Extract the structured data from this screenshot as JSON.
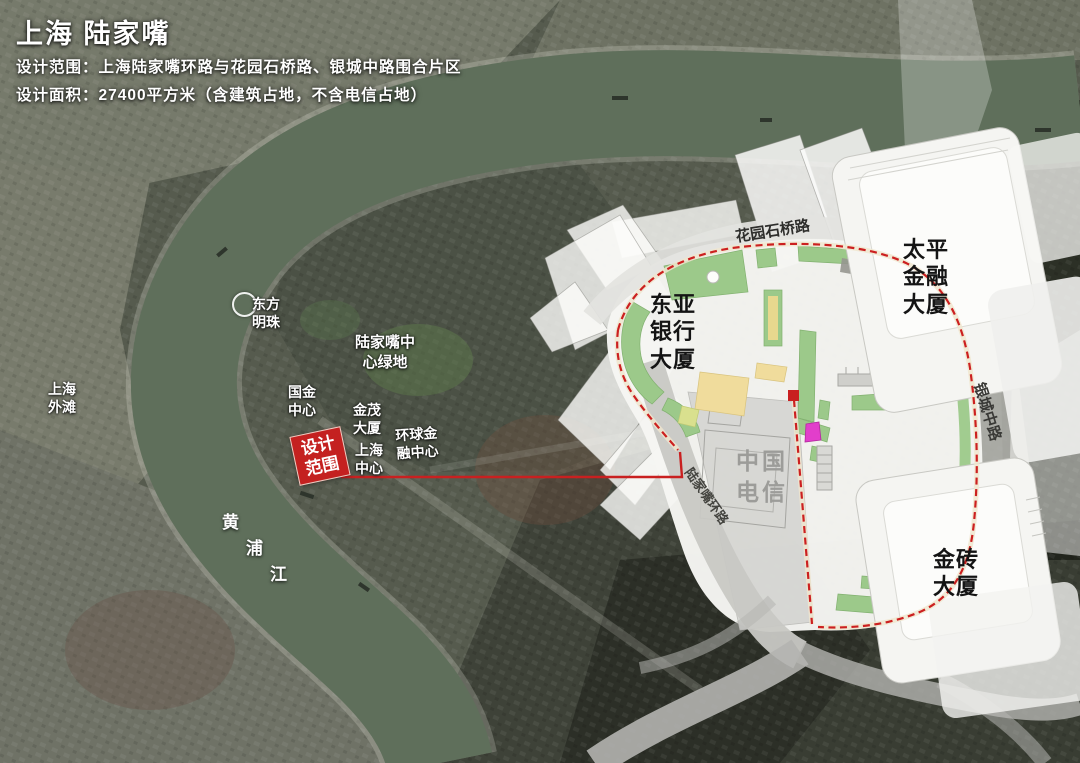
{
  "title": {
    "heading": "上海 陆家嘴",
    "scope_line": "设计范围：上海陆家嘴环路与花园石桥路、银城中路围合片区",
    "area_line": "设计面积：27400平方米（含建筑占地，不含电信占地）"
  },
  "satellite_labels": {
    "oriental_pearl": {
      "line1": "东方",
      "line2": "明珠"
    },
    "bund": {
      "line1": "上海",
      "line2": "外滩"
    },
    "ifc": {
      "line1": "国金",
      "line2": "中心"
    },
    "central_green": {
      "line1": "陆家嘴中",
      "line2": "心绿地"
    },
    "jinmao": {
      "line1": "金茂",
      "line2": "大厦"
    },
    "swfc": {
      "line1": "环球金",
      "line2": "融中心"
    },
    "shanghai_tower": {
      "line1": "上海",
      "line2": "中心"
    },
    "huangpu_river": {
      "char1": "黄",
      "char2": "浦",
      "char3": "江"
    }
  },
  "scope_tag": {
    "line1": "设计",
    "line2": "范围"
  },
  "plan_labels": {
    "east_asia_bank": {
      "line1": "东亚",
      "line2": "银行",
      "line3": "大厦"
    },
    "taiping_finance": {
      "line1": "太平",
      "line2": "金融",
      "line3": "大厦"
    },
    "gold_brick": {
      "line1": "金砖",
      "line2": "大厦"
    },
    "china_telecom": {
      "line1": "中国",
      "line2": "电信"
    },
    "garden_bridge_road": "花园石桥路",
    "yincheng_road": "银城中路",
    "lujiazui_ring_road": "陆家嘴环路"
  },
  "colors": {
    "accent_red": "#c42120",
    "plan_green": "#9cc98a",
    "plan_yellow": "#f0dc9c",
    "water_green": "#5f6f5b",
    "magenta": "#e23ecb"
  }
}
